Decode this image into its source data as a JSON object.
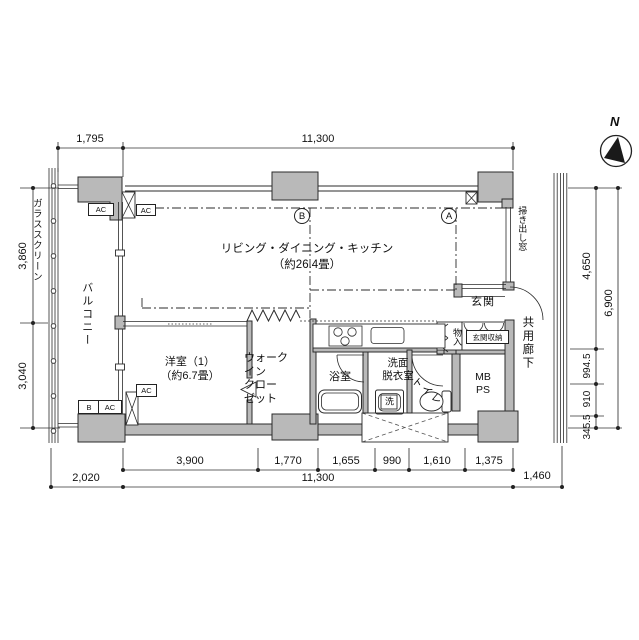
{
  "compass": {
    "north_label": "N"
  },
  "rooms": {
    "ldk": "リビング・ダイニング・キッチン\n（約26.4畳）",
    "western_room": "洋室（1）\n（約6.7畳）",
    "walk_in_closet": "ウォーク\nイン\nクロー\nゼット",
    "bathroom": "浴室",
    "washroom": "洗面\n脱衣室",
    "laundry": "洗",
    "toilet": "トイレ",
    "storage": "物入",
    "entrance": "玄関",
    "entrance_storage": "玄関収納",
    "meter_pipe_space": "MB\nPS",
    "balcony": "バルコニー",
    "glass_screen": "ガラススクリーン",
    "common_corridor": "共用廊下",
    "sliding_window": "掃き出し窓"
  },
  "markers": {
    "point_a": "A",
    "point_b": "B",
    "ac": "AC",
    "b": "B"
  },
  "dimensions": {
    "top": [
      "1,795",
      "11,300"
    ],
    "left": [
      "3,860",
      "3,040"
    ],
    "right": [
      "4,650",
      "994.5",
      "910",
      "345.5"
    ],
    "right_total": "6,900",
    "bottom_upper": [
      "3,900",
      "1,770",
      "1,655",
      "990",
      "1,610",
      "1,375"
    ],
    "bottom_lower": [
      "2,020",
      "11,300",
      "1,460"
    ]
  },
  "colors": {
    "wall_fill": "#b9b9b9",
    "line": "#2b2b2b",
    "background": "#ffffff"
  }
}
